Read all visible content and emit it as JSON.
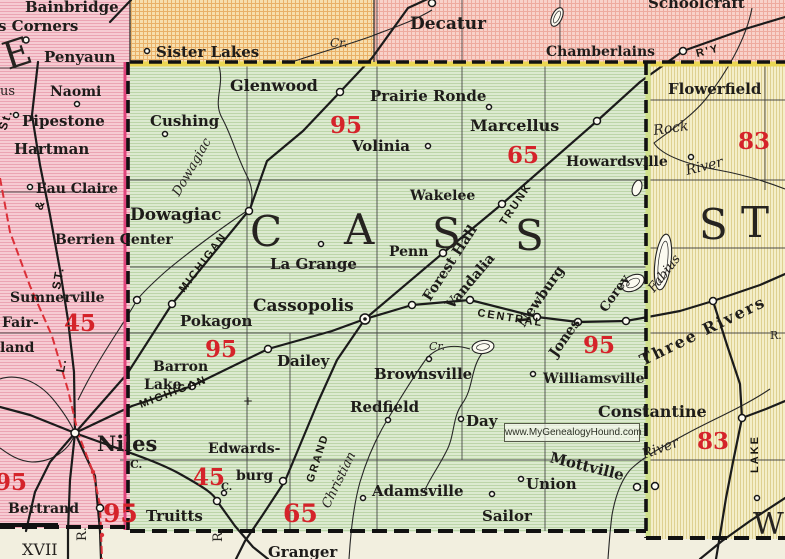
{
  "map": {
    "watermark": "www.MyGenealogyHound.com",
    "colors": {
      "cass_green": "#dcead0",
      "berrien_pink": "#f6ccd3",
      "van_buren_orange": "#f7dfae",
      "kalamazoo_pink": "#f7cfc9",
      "st_joseph_yellow": "#f4eec9",
      "indiana_cream": "#f2efdf",
      "route_red": "#d5232a",
      "boundary_yellow": "#ead653",
      "boundary_pink": "#e0447c"
    },
    "labels": [
      {
        "k": "town",
        "t": "Bainbridge",
        "x": 25,
        "y": 12,
        "s": 15
      },
      {
        "k": "town",
        "t": "s Corners",
        "x": -2,
        "y": 31,
        "s": 15
      },
      {
        "k": "town",
        "t": "Penyaun",
        "x": 44,
        "y": 62,
        "s": 15
      },
      {
        "k": "town",
        "t": "Naomi",
        "x": 50,
        "y": 96,
        "s": 14
      },
      {
        "k": "town",
        "t": "Pipestone",
        "x": 22,
        "y": 126,
        "s": 15
      },
      {
        "k": "town",
        "t": "Hartman",
        "x": 14,
        "y": 154,
        "s": 15
      },
      {
        "k": "town",
        "t": "Eau Claire",
        "x": 36,
        "y": 193,
        "s": 14
      },
      {
        "k": "town",
        "t": "Berrien Center",
        "x": 55,
        "y": 244,
        "s": 14
      },
      {
        "k": "town",
        "t": "Sumnerville",
        "x": 10,
        "y": 302,
        "s": 14
      },
      {
        "k": "town",
        "t": "Fair-",
        "x": 2,
        "y": 327,
        "s": 14
      },
      {
        "k": "town",
        "t": "land",
        "x": 0,
        "y": 352,
        "s": 14
      },
      {
        "k": "town",
        "t": "Niles",
        "x": 97,
        "y": 451,
        "s": 21
      },
      {
        "k": "town",
        "t": "Bertrand",
        "x": 8,
        "y": 513,
        "s": 14
      },
      {
        "k": "town",
        "t": "Sister Lakes",
        "x": 156,
        "y": 57,
        "s": 15
      },
      {
        "k": "town",
        "t": "Decatur",
        "x": 410,
        "y": 29,
        "s": 17
      },
      {
        "k": "town",
        "t": "Chamberlains",
        "x": 546,
        "y": 56,
        "s": 14
      },
      {
        "k": "town",
        "t": "Schoolcraft",
        "x": 648,
        "y": 8,
        "s": 15
      },
      {
        "k": "town",
        "t": "Glenwood",
        "x": 230,
        "y": 91,
        "s": 16
      },
      {
        "k": "town",
        "t": "Cushing",
        "x": 150,
        "y": 126,
        "s": 15
      },
      {
        "k": "town",
        "t": "Prairie Ronde",
        "x": 370,
        "y": 101,
        "s": 15
      },
      {
        "k": "town",
        "t": "Volinia",
        "x": 352,
        "y": 151,
        "s": 15
      },
      {
        "k": "town",
        "t": "Marcellus",
        "x": 470,
        "y": 131,
        "s": 16
      },
      {
        "k": "town",
        "t": "Howardsville",
        "x": 566,
        "y": 166,
        "s": 14
      },
      {
        "k": "town",
        "t": "Wakelee",
        "x": 410,
        "y": 200,
        "s": 14
      },
      {
        "k": "town",
        "t": "Dowagiac",
        "x": 130,
        "y": 220,
        "s": 17
      },
      {
        "k": "town",
        "t": "La Grange",
        "x": 270,
        "y": 269,
        "s": 15
      },
      {
        "k": "town",
        "t": "Penn",
        "x": 389,
        "y": 256,
        "s": 14
      },
      {
        "k": "town",
        "t": "Cassopolis",
        "x": 253,
        "y": 311,
        "s": 17
      },
      {
        "k": "town",
        "t": "Pokagon",
        "x": 180,
        "y": 326,
        "s": 15
      },
      {
        "k": "town",
        "t": "Dailey",
        "x": 277,
        "y": 366,
        "s": 15
      },
      {
        "k": "town",
        "t": "Barron",
        "x": 153,
        "y": 371,
        "s": 14
      },
      {
        "k": "town",
        "t": "Lake",
        "x": 144,
        "y": 389,
        "s": 14
      },
      {
        "k": "town",
        "t": "Brownsville",
        "x": 374,
        "y": 379,
        "s": 15
      },
      {
        "k": "town",
        "t": "Redfield",
        "x": 350,
        "y": 412,
        "s": 15
      },
      {
        "k": "town",
        "t": "Day",
        "x": 466,
        "y": 426,
        "s": 15
      },
      {
        "k": "town",
        "t": "Williamsville",
        "x": 543,
        "y": 383,
        "s": 14
      },
      {
        "k": "town",
        "t": "Edwards-",
        "x": 208,
        "y": 453,
        "s": 14
      },
      {
        "k": "town",
        "t": "burg",
        "x": 236,
        "y": 480,
        "s": 14
      },
      {
        "k": "town",
        "t": "Truitts",
        "x": 146,
        "y": 521,
        "s": 15
      },
      {
        "k": "town",
        "t": "Adamsville",
        "x": 372,
        "y": 496,
        "s": 15
      },
      {
        "k": "town",
        "t": "Sailor",
        "x": 482,
        "y": 521,
        "s": 15
      },
      {
        "k": "town",
        "t": "Union",
        "x": 526,
        "y": 489,
        "s": 15
      },
      {
        "k": "town",
        "t": "Mottville",
        "x": 549,
        "y": 462,
        "s": 15,
        "r": 14
      },
      {
        "k": "town",
        "t": "Granger",
        "x": 268,
        "y": 557,
        "s": 15
      },
      {
        "k": "town",
        "t": "Flowerfield",
        "x": 668,
        "y": 94,
        "s": 15
      },
      {
        "k": "town",
        "t": "Constantine",
        "x": 598,
        "y": 417,
        "s": 16
      },
      {
        "k": "town",
        "t": "Forest Hall",
        "x": 430,
        "y": 302,
        "s": 14,
        "r": -57
      },
      {
        "k": "town",
        "t": "Vandalia",
        "x": 452,
        "y": 310,
        "s": 14,
        "r": -50
      },
      {
        "k": "town",
        "t": "Newburg",
        "x": 524,
        "y": 328,
        "s": 14,
        "r": -55
      },
      {
        "k": "town",
        "t": "Jones",
        "x": 556,
        "y": 358,
        "s": 14,
        "r": -55
      },
      {
        "k": "town",
        "t": "Corey",
        "x": 606,
        "y": 313,
        "s": 13,
        "r": -55
      },
      {
        "k": "town",
        "t": "Three Rivers",
        "x": 643,
        "y": 366,
        "s": 16,
        "r": -26,
        "sp": 2
      },
      {
        "k": "town",
        "t": "C.",
        "x": 130,
        "y": 468,
        "s": 11
      },
      {
        "k": "town",
        "t": "C.",
        "x": 221,
        "y": 490,
        "s": 10
      },
      {
        "k": "county",
        "t": "C",
        "x": 250,
        "y": 246,
        "s": 42
      },
      {
        "k": "county",
        "t": "A",
        "x": 344,
        "y": 244,
        "s": 42
      },
      {
        "k": "county",
        "t": "S",
        "x": 432,
        "y": 248,
        "s": 42
      },
      {
        "k": "county",
        "t": "S",
        "x": 515,
        "y": 250,
        "s": 42
      },
      {
        "k": "county",
        "t": "S",
        "x": 699,
        "y": 239,
        "s": 42
      },
      {
        "k": "county",
        "t": "T",
        "x": 741,
        "y": 237,
        "s": 42
      },
      {
        "k": "county",
        "t": "W",
        "x": 753,
        "y": 534,
        "s": 30
      },
      {
        "k": "county",
        "t": "E",
        "x": 8,
        "y": 70,
        "s": 38,
        "r": -18
      },
      {
        "k": "route",
        "t": "95",
        "x": 330,
        "y": 133,
        "s": 23
      },
      {
        "k": "route",
        "t": "65",
        "x": 507,
        "y": 163,
        "s": 23
      },
      {
        "k": "route",
        "t": "83",
        "x": 738,
        "y": 149,
        "s": 23
      },
      {
        "k": "route",
        "t": "45",
        "x": 64,
        "y": 331,
        "s": 23
      },
      {
        "k": "route",
        "t": "95",
        "x": 205,
        "y": 357,
        "s": 23
      },
      {
        "k": "route",
        "t": "95",
        "x": 583,
        "y": 353,
        "s": 23
      },
      {
        "k": "route",
        "t": "95",
        "x": -5,
        "y": 490,
        "s": 23
      },
      {
        "k": "route",
        "t": "95",
        "x": 103,
        "y": 522,
        "s": 25
      },
      {
        "k": "route",
        "t": "45",
        "x": 193,
        "y": 485,
        "s": 23
      },
      {
        "k": "route",
        "t": "65",
        "x": 283,
        "y": 522,
        "s": 25
      },
      {
        "k": "route",
        "t": "83",
        "x": 697,
        "y": 449,
        "s": 23
      },
      {
        "k": "rail",
        "t": "MICHIGAN",
        "x": 184,
        "y": 293,
        "s": 11,
        "r": -53
      },
      {
        "k": "rail",
        "t": "MICHIGAN",
        "x": 141,
        "y": 408,
        "s": 11,
        "r": -21
      },
      {
        "k": "rail",
        "t": "CENTRAL",
        "x": 477,
        "y": 316,
        "s": 11,
        "r": 9,
        "sp": 4
      },
      {
        "k": "rail",
        "t": "GRAND",
        "x": 313,
        "y": 483,
        "s": 11,
        "r": -72
      },
      {
        "k": "rail",
        "t": "TRUNK",
        "x": 505,
        "y": 226,
        "s": 11,
        "r": -56
      },
      {
        "k": "rail",
        "t": "R'Y",
        "x": 697,
        "y": 57,
        "s": 11,
        "r": -14
      },
      {
        "k": "rail",
        "t": "LAKE",
        "x": 758,
        "y": 473,
        "s": 11,
        "r": -90
      },
      {
        "k": "rail",
        "t": "St.",
        "x": 6,
        "y": 131,
        "s": 12,
        "r": -72
      },
      {
        "k": "rail",
        "t": "&",
        "x": 42,
        "y": 211,
        "s": 12,
        "r": -72
      },
      {
        "k": "rail",
        "t": "ST.",
        "x": 60,
        "y": 290,
        "s": 12,
        "r": -80
      },
      {
        "k": "rail",
        "t": "L.",
        "x": 64,
        "y": 373,
        "s": 12,
        "r": -80
      },
      {
        "k": "water",
        "t": "Dowagiac",
        "x": 179,
        "y": 197,
        "s": 13,
        "r": -60
      },
      {
        "k": "water",
        "t": "Christian",
        "x": 329,
        "y": 509,
        "s": 13,
        "r": -64
      },
      {
        "k": "water",
        "t": "Rock",
        "x": 654,
        "y": 135,
        "s": 14,
        "r": -8
      },
      {
        "k": "water",
        "t": "River",
        "x": 687,
        "y": 175,
        "s": 14,
        "r": -14
      },
      {
        "k": "water",
        "t": "River",
        "x": 644,
        "y": 459,
        "s": 14,
        "r": -20
      },
      {
        "k": "water",
        "t": "Cr.",
        "x": 429,
        "y": 350,
        "s": 11
      },
      {
        "k": "water",
        "t": "Cr.",
        "x": 330,
        "y": 47,
        "s": 12
      },
      {
        "k": "water",
        "t": "Fabius",
        "x": 654,
        "y": 293,
        "s": 13,
        "r": -52
      },
      {
        "k": "misc",
        "t": "XVII",
        "x": 22,
        "y": 555,
        "s": 16
      },
      {
        "k": "misc",
        "t": "R.",
        "x": 86,
        "y": 541,
        "s": 13,
        "r": -90
      },
      {
        "k": "misc",
        "t": "R.",
        "x": 222,
        "y": 542,
        "s": 13,
        "r": -90
      },
      {
        "k": "misc",
        "t": "R.",
        "x": 770,
        "y": 339,
        "s": 11
      },
      {
        "k": "misc",
        "t": "us",
        "x": 0,
        "y": 95,
        "s": 13
      },
      {
        "k": "misc",
        "t": "+",
        "x": 243,
        "y": 405,
        "s": 12
      }
    ]
  }
}
